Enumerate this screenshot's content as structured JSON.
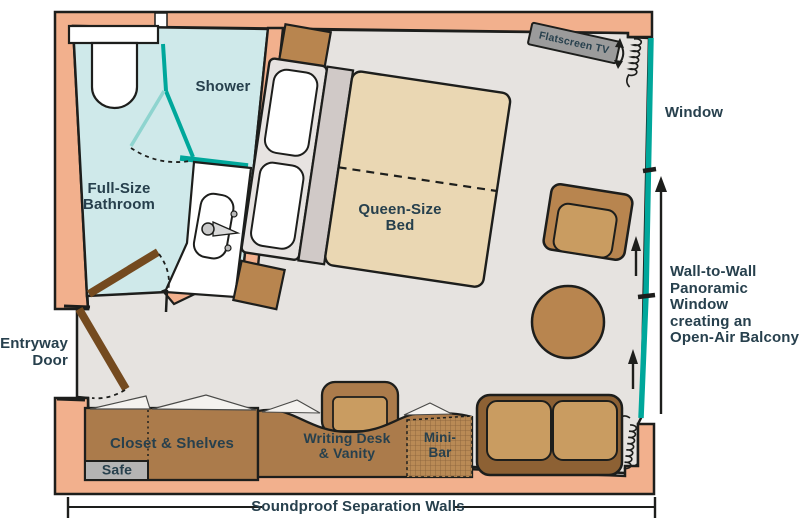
{
  "labels": {
    "shower": "Shower",
    "full_bathroom": "Full-Size\nBathroom",
    "queen_bed": "Queen-Size\nBed",
    "flatscreen_tv": "Flatscreen TV",
    "window": "Window",
    "panoramic_window": "Wall-to-Wall\nPanoramic Window\ncreating an\nOpen-Air Balcony",
    "entryway_door": "Entryway\nDoor",
    "closet": "Closet & Shelves",
    "safe": "Safe",
    "writing_desk": "Writing Desk\n& Vanity",
    "minibar": "Mini-\nBar",
    "soundproof": "Soundproof Separation Walls"
  },
  "colors": {
    "wall": "#f2b08d",
    "floor": "#e6e3e0",
    "bath": "#cfe9ea",
    "teal": "#00a79b",
    "teal_light": "#8ed4cf",
    "ink": "#1d1e1c",
    "text": "#27404d",
    "wood": "#ab7b4b",
    "wood_mid": "#b8854f",
    "wood_light": "#c99c61",
    "sofa": "#8d6134",
    "door": "#744a1f",
    "bed": "#ead7b3",
    "bed_band": "#d0c9c7",
    "bed_panel": "#e7e3e1",
    "safe": "#b4b4b4",
    "tv": "#9b9b9b"
  }
}
